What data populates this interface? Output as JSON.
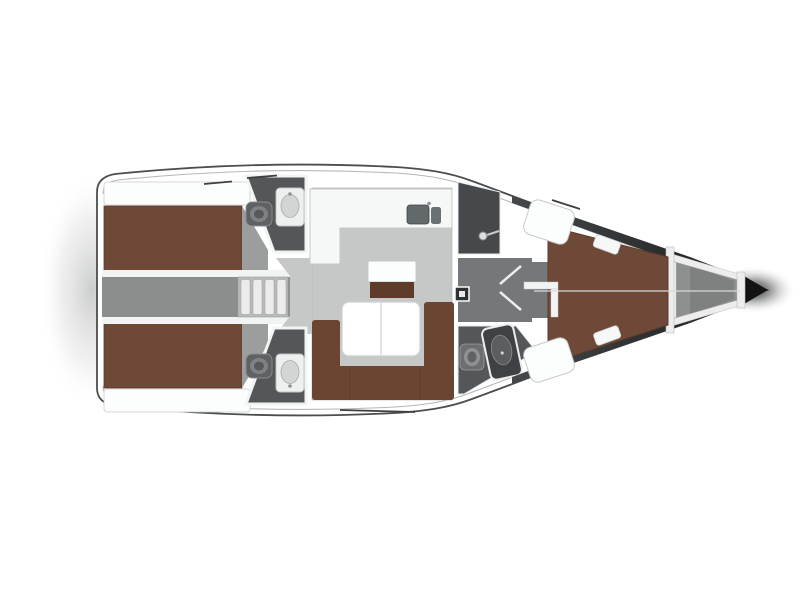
{
  "colors": {
    "background": "#ffffff",
    "hull_outline": "#4b4d4e",
    "deck": "#ffffff",
    "sheer_line": "#b5b7b8",
    "stern_shadow": "#c3c4c5",
    "hull_side_dark": "#45484a",
    "bow_tip": "#131313",
    "anchor_locker": "#8d908f",
    "locker_inner": "#7e8180",
    "rib_white": "#ededee",
    "salon_floor": "#c6c8c7",
    "passage_floor": "#8b8e8d",
    "doorway_floor": "#75787a",
    "cabin_entry_floor": "#9b9e9d",
    "head_floor": "#54575a",
    "wet_floor": "#46494b",
    "steps": "#b9bbbb",
    "step_tread": "#ececec",
    "berth": "#6e4937",
    "berth_edge": "#5a3a2b",
    "sofa": "#6b4531",
    "seat_base": "#5e3b2b",
    "table": "#ffffff",
    "counter": "#f6f7f7",
    "shelf": "#fcfdfd",
    "wall": "#f2f3f3",
    "sink_basin": "#63686a",
    "toilet": "#5e6264",
    "toilet_seat": "#7e8284",
    "basin_gray": "#d3d5d5",
    "stall_dark": "#3f4244",
    "panel": "#2e3133",
    "hatch_line": "#3f3f3f"
  }
}
